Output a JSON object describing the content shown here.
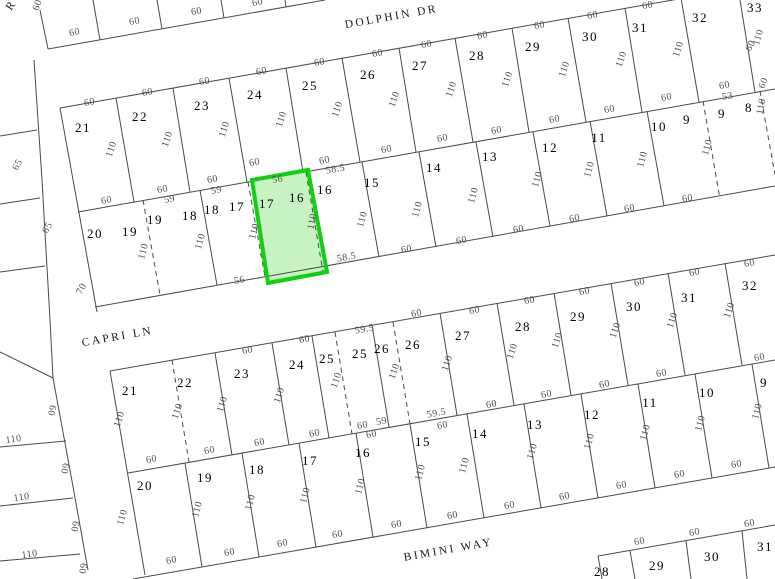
{
  "canvas": {
    "width": 775,
    "height": 579,
    "background": "#ffffff"
  },
  "styles": {
    "line_color": "#4a4a4a",
    "dim_color": "#4d4d4d",
    "number_color": "#000000",
    "street_color": "#1a1a1a",
    "highlight_fill": "#c9f2c4",
    "highlight_stroke": "#10d010"
  },
  "streets": [
    {
      "label": "DOLPHIN DR",
      "x": 392,
      "y": 20,
      "rot": -10
    },
    {
      "label": "CAPRI LN",
      "x": 118,
      "y": 340,
      "rot": -10
    },
    {
      "label": "BIMINI WAY",
      "x": 449,
      "y": 553,
      "rot": -10
    },
    {
      "label": "R",
      "x": 14,
      "y": 7,
      "rot": -55
    }
  ],
  "highlight_parcel": {
    "points": "252,180 308,170 327,272 268,283"
  },
  "lot_numbers": [
    [
      "21",
      83,
      132
    ],
    [
      "22",
      140,
      121
    ],
    [
      "23",
      202,
      110
    ],
    [
      "24",
      255,
      99
    ],
    [
      "25",
      310,
      90
    ],
    [
      "26",
      368,
      79
    ],
    [
      "27",
      420,
      70
    ],
    [
      "28",
      477,
      60
    ],
    [
      "29",
      533,
      51
    ],
    [
      "30",
      590,
      41
    ],
    [
      "31",
      640,
      32
    ],
    [
      "32",
      700,
      22
    ],
    [
      "33",
      755,
      12
    ],
    [
      "20",
      95,
      238
    ],
    [
      "19",
      130,
      236
    ],
    [
      "19",
      155,
      224
    ],
    [
      "18",
      190,
      220
    ],
    [
      "18",
      212,
      214
    ],
    [
      "17",
      237,
      211
    ],
    [
      "17",
      267,
      208
    ],
    [
      "16",
      297,
      202
    ],
    [
      "16",
      325,
      194
    ],
    [
      "15",
      372,
      187
    ],
    [
      "14",
      434,
      172
    ],
    [
      "13",
      490,
      161
    ],
    [
      "12",
      550,
      152
    ],
    [
      "11",
      599,
      142
    ],
    [
      "10",
      659,
      131
    ],
    [
      "9",
      687,
      124
    ],
    [
      "9",
      722,
      118
    ],
    [
      "8",
      749,
      112
    ],
    [
      "21",
      130,
      395
    ],
    [
      "22",
      185,
      387
    ],
    [
      "23",
      242,
      378
    ],
    [
      "24",
      297,
      369
    ],
    [
      "25",
      327,
      363
    ],
    [
      "25",
      360,
      358
    ],
    [
      "26",
      382,
      353
    ],
    [
      "26",
      413,
      349
    ],
    [
      "27",
      463,
      340
    ],
    [
      "28",
      523,
      331
    ],
    [
      "29",
      578,
      321
    ],
    [
      "30",
      634,
      311
    ],
    [
      "31",
      689,
      302
    ],
    [
      "32",
      750,
      290
    ],
    [
      "20",
      145,
      490
    ],
    [
      "19",
      205,
      482
    ],
    [
      "18",
      257,
      474
    ],
    [
      "17",
      310,
      465
    ],
    [
      "16",
      363,
      457
    ],
    [
      "15",
      423,
      446
    ],
    [
      "14",
      480,
      438
    ],
    [
      "13",
      535,
      429
    ],
    [
      "12",
      592,
      419
    ],
    [
      "11",
      650,
      407
    ],
    [
      "10",
      707,
      397
    ],
    [
      "9",
      764,
      387
    ],
    [
      "28",
      602,
      576
    ],
    [
      "29",
      657,
      570
    ],
    [
      "30",
      712,
      561
    ],
    [
      "31",
      765,
      551
    ]
  ],
  "dimensions": [
    [
      "60",
      75,
      35,
      -10
    ],
    [
      "60",
      135,
      24,
      -10
    ],
    [
      "60",
      197,
      14,
      -10
    ],
    [
      "60",
      258,
      5,
      -10
    ],
    [
      "60",
      40,
      6,
      -70
    ],
    [
      "60",
      90,
      105,
      -10
    ],
    [
      "60",
      148,
      95,
      -10
    ],
    [
      "60",
      205,
      84,
      -10
    ],
    [
      "60",
      262,
      74,
      -10
    ],
    [
      "60",
      320,
      65,
      -10
    ],
    [
      "60",
      378,
      56,
      -10
    ],
    [
      "60",
      427,
      47,
      -10
    ],
    [
      "60",
      483,
      38,
      -10
    ],
    [
      "60",
      540,
      28,
      -10
    ],
    [
      "60",
      593,
      18,
      -10
    ],
    [
      "60",
      648,
      8,
      -10
    ],
    [
      "110",
      114,
      150,
      -72
    ],
    [
      "110",
      170,
      140,
      -72
    ],
    [
      "110",
      227,
      130,
      -72
    ],
    [
      "110",
      284,
      120,
      -72
    ],
    [
      "110",
      340,
      110,
      -72
    ],
    [
      "110",
      397,
      100,
      -72
    ],
    [
      "110",
      454,
      90,
      -72
    ],
    [
      "110",
      510,
      80,
      -72
    ],
    [
      "110",
      567,
      70,
      -72
    ],
    [
      "110",
      624,
      60,
      -72
    ],
    [
      "110",
      681,
      50,
      -72
    ],
    [
      "110",
      761,
      38,
      -74
    ],
    [
      "60",
      753,
      47,
      -62
    ],
    [
      "60",
      766,
      84,
      -68
    ],
    [
      "60",
      107,
      203,
      -10
    ],
    [
      "60",
      163,
      192,
      -10
    ],
    [
      "59",
      170,
      202,
      -10
    ],
    [
      "60",
      213,
      182,
      -10
    ],
    [
      "59",
      217,
      193,
      -10
    ],
    [
      "60",
      255,
      165,
      -10
    ],
    [
      "56",
      278,
      182,
      -10
    ],
    [
      "60",
      325,
      163,
      -10
    ],
    [
      "58.5",
      336,
      172,
      -10
    ],
    [
      "60",
      387,
      152,
      -10
    ],
    [
      "60",
      443,
      141,
      -10
    ],
    [
      "60",
      497,
      133,
      -10
    ],
    [
      "60",
      555,
      122,
      -10
    ],
    [
      "60",
      610,
      112,
      -10
    ],
    [
      "60",
      667,
      100,
      -10
    ],
    [
      "53",
      728,
      99,
      -10
    ],
    [
      "60",
      725,
      88,
      -10
    ],
    [
      "110",
      146,
      252,
      -75
    ],
    [
      "110",
      203,
      242,
      -75
    ],
    [
      "110",
      257,
      232,
      -75
    ],
    [
      "110",
      315,
      222,
      -78
    ],
    [
      "110",
      365,
      220,
      -75
    ],
    [
      "110",
      420,
      210,
      -75
    ],
    [
      "110",
      476,
      196,
      -75
    ],
    [
      "110",
      540,
      180,
      -75
    ],
    [
      "110",
      592,
      170,
      -75
    ],
    [
      "110",
      645,
      160,
      -75
    ],
    [
      "110",
      710,
      148,
      -75
    ],
    [
      "110",
      764,
      107,
      -78
    ],
    [
      "56",
      240,
      283,
      -10
    ],
    [
      "58.5",
      347,
      260,
      -10
    ],
    [
      "60",
      407,
      252,
      -10
    ],
    [
      "60",
      462,
      243,
      -10
    ],
    [
      "60",
      519,
      232,
      -10
    ],
    [
      "60",
      575,
      221,
      -10
    ],
    [
      "60",
      630,
      211,
      -10
    ],
    [
      "60",
      688,
      201,
      -10
    ],
    [
      "60",
      248,
      353,
      -10
    ],
    [
      "60",
      305,
      342,
      -10
    ],
    [
      "59.5",
      365,
      332,
      -10
    ],
    [
      "60",
      417,
      316,
      -10
    ],
    [
      "60",
      475,
      313,
      -10
    ],
    [
      "60",
      530,
      303,
      -10
    ],
    [
      "60",
      585,
      294,
      -10
    ],
    [
      "60",
      640,
      285,
      -10
    ],
    [
      "60",
      695,
      275,
      -10
    ],
    [
      "60",
      750,
      266,
      -10
    ],
    [
      "110",
      122,
      420,
      -72
    ],
    [
      "110",
      180,
      412,
      -72
    ],
    [
      "110",
      225,
      405,
      -72
    ],
    [
      "110",
      282,
      396,
      -72
    ],
    [
      "110",
      339,
      381,
      -72
    ],
    [
      "110",
      397,
      372,
      -72
    ],
    [
      "110",
      450,
      364,
      -72
    ],
    [
      "110",
      515,
      352,
      -72
    ],
    [
      "110",
      560,
      341,
      -72
    ],
    [
      "110",
      618,
      331,
      -72
    ],
    [
      "110",
      675,
      321,
      -72
    ],
    [
      "110",
      732,
      311,
      -72
    ],
    [
      "60",
      152,
      462,
      -10
    ],
    [
      "60",
      210,
      453,
      -10
    ],
    [
      "60",
      260,
      445,
      -10
    ],
    [
      "60",
      315,
      436,
      -10
    ],
    [
      "60",
      363,
      428,
      -10
    ],
    [
      "59",
      382,
      424,
      -10
    ],
    [
      "60",
      372,
      437,
      -10
    ],
    [
      "59.5",
      437,
      416,
      -10
    ],
    [
      "60",
      443,
      428,
      -10
    ],
    [
      "60",
      492,
      407,
      -10
    ],
    [
      "60",
      547,
      397,
      -10
    ],
    [
      "60",
      605,
      387,
      -10
    ],
    [
      "60",
      662,
      376,
      -10
    ],
    [
      "60",
      760,
      360,
      -10
    ],
    [
      "110",
      125,
      518,
      -75
    ],
    [
      "110",
      200,
      510,
      -75
    ],
    [
      "110",
      253,
      503,
      -75
    ],
    [
      "110",
      308,
      496,
      -75
    ],
    [
      "110",
      363,
      487,
      -75
    ],
    [
      "110",
      423,
      473,
      -75
    ],
    [
      "110",
      467,
      466,
      -75
    ],
    [
      "110",
      535,
      452,
      -75
    ],
    [
      "110",
      592,
      442,
      -75
    ],
    [
      "110",
      648,
      433,
      -75
    ],
    [
      "110",
      703,
      424,
      -75
    ],
    [
      "110",
      760,
      412,
      -75
    ],
    [
      "60",
      172,
      563,
      -10
    ],
    [
      "60",
      230,
      555,
      -10
    ],
    [
      "60",
      283,
      546,
      -10
    ],
    [
      "60",
      338,
      537,
      -10
    ],
    [
      "60",
      397,
      527,
      -10
    ],
    [
      "60",
      453,
      518,
      -10
    ],
    [
      "60",
      510,
      508,
      -10
    ],
    [
      "60",
      565,
      499,
      -10
    ],
    [
      "60",
      622,
      488,
      -10
    ],
    [
      "60",
      680,
      477,
      -10
    ],
    [
      "60",
      737,
      467,
      -10
    ],
    [
      "60",
      640,
      544,
      -10
    ],
    [
      "60",
      695,
      535,
      -10
    ],
    [
      "60",
      750,
      526,
      -10
    ],
    [
      "110",
      14,
      442,
      -8
    ],
    [
      "110",
      22,
      500,
      -8
    ],
    [
      "110",
      30,
      557,
      -8
    ],
    [
      "65",
      20,
      166,
      -62
    ],
    [
      "65",
      50,
      229,
      -62
    ],
    [
      "70",
      84,
      290,
      -62
    ],
    [
      "60",
      49,
      410,
      100
    ],
    [
      "60",
      62,
      468,
      100
    ],
    [
      "60",
      72,
      526,
      100
    ],
    [
      "60",
      80,
      568,
      100
    ]
  ],
  "lines": {
    "solid": [
      [
        40,
        10,
        48,
        49
      ],
      [
        48,
        49,
        325,
        0
      ],
      [
        93,
        0,
        100,
        40
      ],
      [
        157,
        0,
        162,
        29
      ],
      [
        221,
        0,
        224,
        18
      ],
      [
        285,
        0,
        286,
        7
      ],
      [
        60,
        108,
        775,
        -18
      ],
      [
        78,
        212,
        775,
        89
      ],
      [
        95,
        307,
        775,
        186
      ],
      [
        60,
        108,
        97,
        312
      ],
      [
        116,
        98,
        134,
        202
      ],
      [
        173,
        88,
        190,
        192
      ],
      [
        229,
        78,
        247,
        182
      ],
      [
        286,
        68,
        303,
        172
      ],
      [
        342,
        58,
        360,
        162
      ],
      [
        399,
        48,
        416,
        152
      ],
      [
        455,
        38,
        473,
        142
      ],
      [
        512,
        28,
        529,
        132
      ],
      [
        568,
        18,
        586,
        122
      ],
      [
        625,
        8,
        642,
        112
      ],
      [
        681,
        -2,
        699,
        102
      ],
      [
        738,
        -12,
        755,
        92
      ],
      [
        200,
        190,
        217,
        285
      ],
      [
        362,
        162,
        379,
        257
      ],
      [
        419,
        152,
        436,
        247
      ],
      [
        476,
        142,
        493,
        237
      ],
      [
        533,
        132,
        550,
        226
      ],
      [
        590,
        121,
        607,
        216
      ],
      [
        647,
        111,
        664,
        206
      ],
      [
        110,
        371,
        775,
        255
      ],
      [
        128,
        473,
        775,
        360
      ],
      [
        133,
        579,
        775,
        467
      ],
      [
        110,
        371,
        145,
        575
      ],
      [
        215,
        353,
        232,
        455
      ],
      [
        272,
        343,
        289,
        445
      ],
      [
        312,
        336,
        329,
        438
      ],
      [
        372,
        325,
        389,
        427
      ],
      [
        440,
        313,
        457,
        415
      ],
      [
        497,
        303,
        514,
        405
      ],
      [
        554,
        293,
        571,
        395
      ],
      [
        611,
        283,
        628,
        385
      ],
      [
        668,
        273,
        685,
        375
      ],
      [
        725,
        263,
        742,
        365
      ],
      [
        185,
        463,
        202,
        567
      ],
      [
        242,
        453,
        259,
        557
      ],
      [
        299,
        443,
        316,
        547
      ],
      [
        356,
        433,
        373,
        537
      ],
      [
        410,
        424,
        427,
        528
      ],
      [
        467,
        414,
        484,
        518
      ],
      [
        524,
        404,
        541,
        508
      ],
      [
        581,
        394,
        598,
        498
      ],
      [
        638,
        384,
        655,
        488
      ],
      [
        695,
        374,
        712,
        478
      ],
      [
        752,
        364,
        769,
        468
      ],
      [
        598,
        556,
        775,
        525
      ],
      [
        598,
        556,
        602,
        579
      ],
      [
        630,
        551,
        635,
        579
      ],
      [
        686,
        541,
        691,
        579
      ],
      [
        742,
        531,
        747,
        579
      ],
      [
        34,
        60,
        42,
        180
      ],
      [
        42,
        180,
        50,
        320
      ],
      [
        50,
        320,
        53,
        378
      ],
      [
        53,
        378,
        70,
        470
      ],
      [
        70,
        470,
        88,
        570
      ],
      [
        0,
        136,
        37,
        130
      ],
      [
        0,
        204,
        40,
        198
      ],
      [
        0,
        272,
        45,
        266
      ],
      [
        0,
        352,
        53,
        378
      ],
      [
        0,
        447,
        66,
        441
      ],
      [
        0,
        506,
        73,
        498
      ],
      [
        0,
        561,
        80,
        554
      ]
    ],
    "dashed": [
      [
        143,
        200,
        160,
        295
      ],
      [
        248,
        182,
        265,
        277
      ],
      [
        306,
        172,
        323,
        272
      ],
      [
        703,
        101,
        720,
        199
      ],
      [
        760,
        91,
        775,
        175
      ],
      [
        172,
        360,
        189,
        462
      ],
      [
        335,
        332,
        352,
        434
      ],
      [
        393,
        322,
        410,
        424
      ]
    ]
  }
}
